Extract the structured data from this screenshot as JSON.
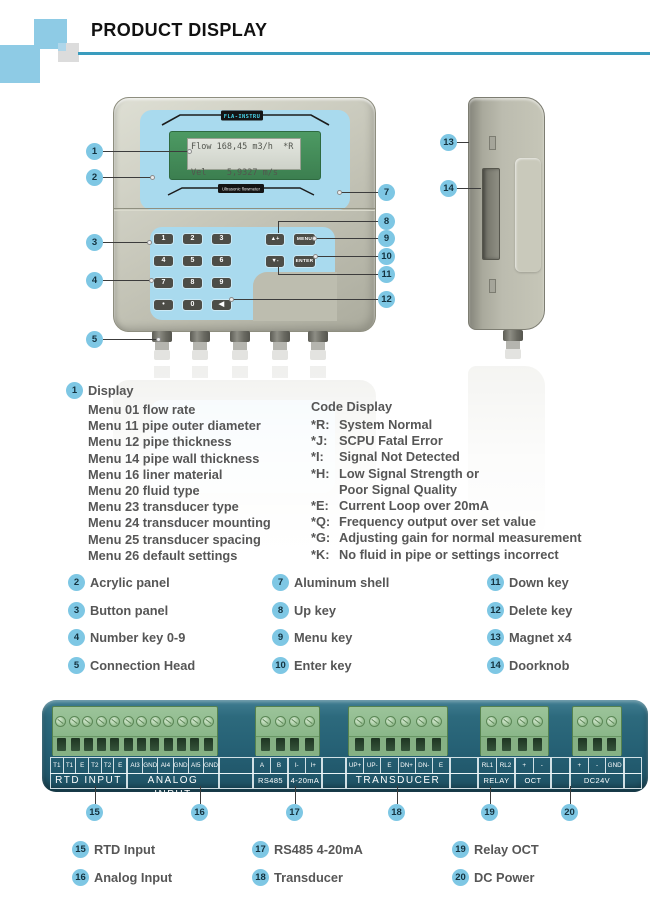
{
  "header": {
    "title": "PRODUCT DISPLAY"
  },
  "device": {
    "brand": "FLA-INSTRU",
    "type_label": "Ultrasonic flowmeter",
    "lcd": {
      "line1": "Flow 168,45 m3/h  *R",
      "line2": "Vel    5,9327 m/s"
    },
    "number_keys": [
      "1",
      "2",
      "3",
      "4",
      "5",
      "6",
      "7",
      "8",
      "9",
      "•",
      "0",
      "◀"
    ],
    "function_keys": [
      "▲+",
      "MENU",
      "▼-",
      "ENTER"
    ]
  },
  "display_info": {
    "badge": "1",
    "heading": "Display",
    "menu_items": [
      "Menu 01 flow rate",
      "Menu 11 pipe outer diameter",
      "Menu 12 pipe thickness",
      "Menu 14 pipe wall thickness",
      "Menu 16 liner material",
      "Menu 20 fluid type",
      "Menu 23 transducer type",
      "Menu 24 transducer mounting",
      "Menu 25 transducer spacing",
      "Menu 26 default settings"
    ]
  },
  "code_display": {
    "heading": "Code Display",
    "items": [
      {
        "code": "*R:",
        "desc": "System Normal"
      },
      {
        "code": "*J:",
        "desc": "SCPU Fatal Error"
      },
      {
        "code": "*I:",
        "desc": "Signal Not Detected"
      },
      {
        "code": "*H:",
        "desc": "Low Signal Strength or"
      },
      {
        "code": "",
        "desc": "Poor Signal Quality"
      },
      {
        "code": "*E:",
        "desc": "Current Loop over 20mA"
      },
      {
        "code": "*Q:",
        "desc": "Frequency output over set value"
      },
      {
        "code": "*G:",
        "desc": "Adjusting gain for normal measurement"
      },
      {
        "code": "*K:",
        "desc": "No fluid in pipe or settings incorrect"
      }
    ]
  },
  "legend": {
    "items": [
      {
        "n": "2",
        "label": "Acrylic panel"
      },
      {
        "n": "3",
        "label": "Button panel"
      },
      {
        "n": "4",
        "label": "Number key 0-9"
      },
      {
        "n": "5",
        "label": "Connection Head"
      },
      {
        "n": "7",
        "label": "Aluminum shell"
      },
      {
        "n": "8",
        "label": "Up key"
      },
      {
        "n": "9",
        "label": "Menu key"
      },
      {
        "n": "10",
        "label": "Enter key"
      },
      {
        "n": "11",
        "label": "Down key"
      },
      {
        "n": "12",
        "label": "Delete key"
      },
      {
        "n": "13",
        "label": "Magnet x4"
      },
      {
        "n": "14",
        "label": "Doorknob"
      }
    ]
  },
  "bottom_legend": {
    "items": [
      {
        "n": "15",
        "label": "RTD Input"
      },
      {
        "n": "16",
        "label": "Analog Input"
      },
      {
        "n": "17",
        "label": "RS485 4-20mA"
      },
      {
        "n": "18",
        "label": "Transducer"
      },
      {
        "n": "19",
        "label": "Relay OCT"
      },
      {
        "n": "20",
        "label": "DC Power"
      }
    ]
  },
  "callouts": [
    "1",
    "2",
    "3",
    "4",
    "5",
    "7",
    "8",
    "9",
    "10",
    "11",
    "12",
    "13",
    "14"
  ],
  "bottom_callouts": [
    "15",
    "16",
    "17",
    "18",
    "19",
    "20"
  ],
  "terminal": {
    "cell_groups": [
      {
        "cells": [
          "T1",
          "T1",
          "E",
          "T2",
          "T2",
          "E"
        ]
      },
      {
        "cells": [
          "AI3",
          "GND",
          "AI4",
          "GND",
          "AI5",
          "GND"
        ]
      },
      {
        "cells": [
          "A",
          "B"
        ]
      },
      {
        "cells": [
          "I-",
          "I+"
        ]
      },
      {
        "cells": [
          "UP+",
          "UP-",
          "E",
          "DN+",
          "DN-",
          "E"
        ]
      },
      {
        "cells": [
          "RL1",
          "RL2"
        ]
      },
      {
        "cells": [
          "+",
          "-"
        ]
      },
      {
        "cells": [
          "+",
          "-",
          "GND"
        ]
      }
    ],
    "sections": [
      "RTD INPUT",
      "ANALOG INPUT",
      "RS485",
      "4-20mA",
      "TRANSDUCER",
      "RELAY",
      "OCT",
      "DC24V"
    ]
  },
  "colors": {
    "accent": "#3a9cbe",
    "callout_badge": "#7ec7e4",
    "acrylic_blue": "#a9daee",
    "lcd_green": "#47915d",
    "terminal_teal": "#2a6273",
    "terminal_green": "#84b284"
  }
}
